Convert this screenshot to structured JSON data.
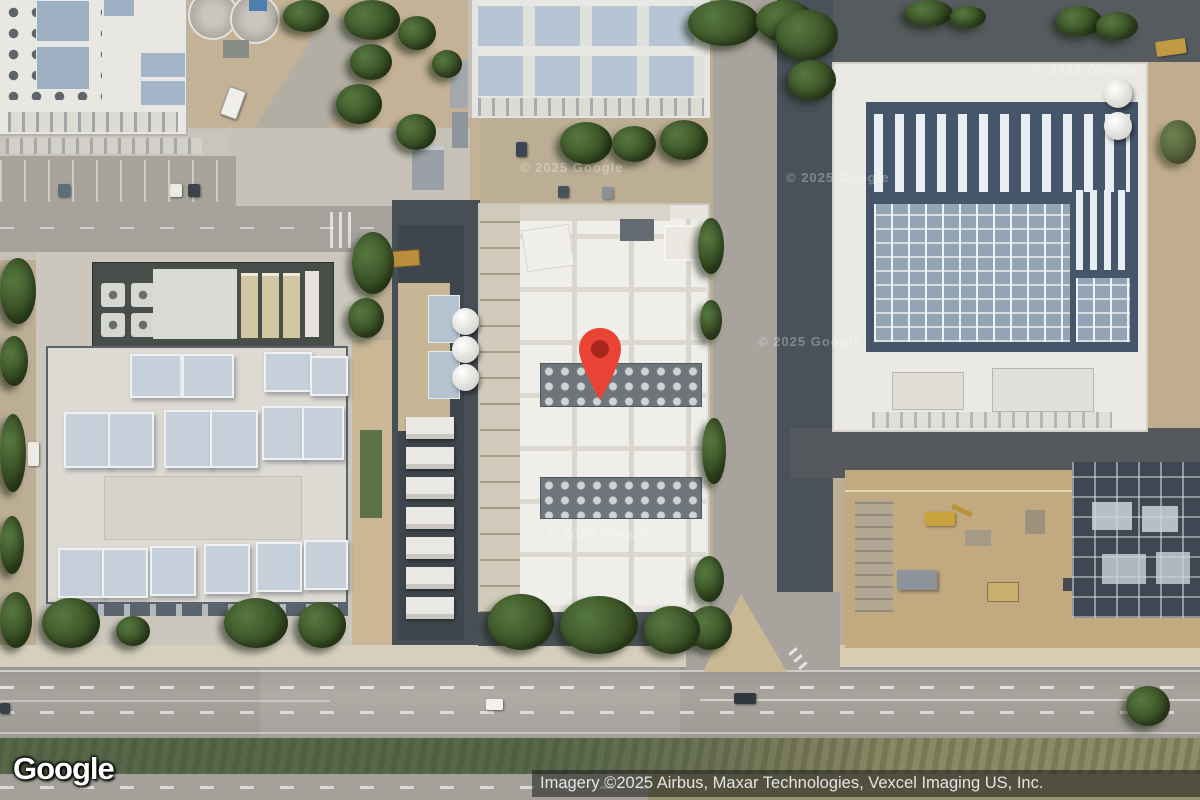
{
  "map": {
    "logo_text": "Google",
    "watermark_text": "© 2025 Google",
    "attribution_text": "Imagery ©2025 Airbus, Maxar Technologies, Vexcel Imaging US, Inc.",
    "marker": {
      "color": "#EA4335",
      "dot_color": "#A8271C"
    },
    "colors": {
      "road": "#a19d96",
      "grass_median": "#5c6e4e",
      "building_roof": "#e9e7e1",
      "cooling_panels": "#b6c4d3",
      "construction_dirt": "#c2a97f",
      "attribution_bg": "rgba(25,25,25,0.55)"
    }
  }
}
